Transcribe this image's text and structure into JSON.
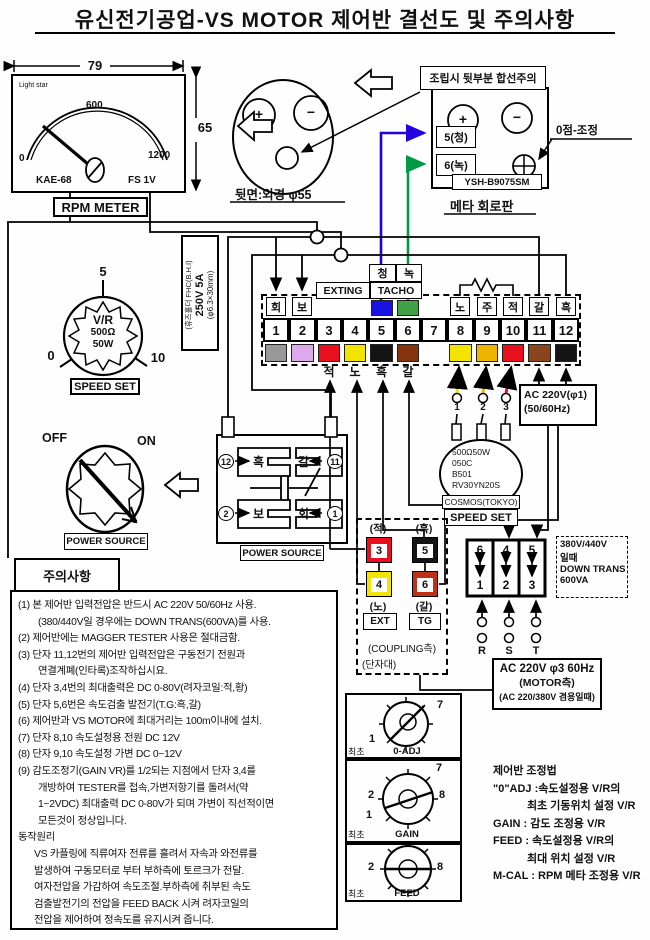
{
  "title": "유신전기공업-VS MOTOR 제어반 결선도 및 주의사항",
  "rpm": {
    "dim_w": "79",
    "dim_h": "65",
    "brand": "Light star",
    "s0": "0",
    "s600": "600",
    "s1200": "1200",
    "model": "KAE-68",
    "fs": "FS 1V",
    "label": "RPM METER"
  },
  "rear": {
    "plus": "+",
    "minus": "−",
    "label": "뒷면:외경 φ55"
  },
  "board": {
    "warning": "조립시 뒷부분 합선주의",
    "plus": "+",
    "minus": "−",
    "t5": "5(청)",
    "t6": "6(녹)",
    "model": "YSH-B9075SM",
    "zero": "0점-조정",
    "label": "메타 회로판"
  },
  "fuse": {
    "l1": "(휴즈홀더 FHC(B.H.I)",
    "l2": "250V 5A",
    "l3": "(φ6.3×30mm)"
  },
  "vr": {
    "s5": "5",
    "s0": "0",
    "s10": "10",
    "name": "V/R",
    "ohm": "500Ω",
    "watt": "50W",
    "label": "SPEED SET"
  },
  "sw": {
    "off": "OFF",
    "on": "ON",
    "label": "POWER SOURCE"
  },
  "relay": {
    "n12": "12",
    "blk": "흑",
    "brn": "갈",
    "n11": "11",
    "n2": "2",
    "bo": "보",
    "hoe": "회",
    "n1": "1",
    "label": "POWER SOURCE"
  },
  "strip": {
    "chung": "청",
    "nok": "녹",
    "exting": "EXTING",
    "tacho": "TACHO",
    "top1": "회",
    "top2": "보",
    "top8": "노",
    "top9": "주",
    "top10": "적",
    "top11": "갈",
    "top12": "흑",
    "numbers": [
      "1",
      "2",
      "3",
      "4",
      "5",
      "6",
      "7",
      "8",
      "9",
      "10",
      "11",
      "12"
    ],
    "bot3": "적",
    "bot4": "노",
    "bot5": "흑",
    "bot6": "갈",
    "w1": "1",
    "w2": "2",
    "w3": "3"
  },
  "ac1": {
    "l1": "AC 220V(φ1)",
    "l2": "(50/60Hz)"
  },
  "pot": {
    "l1": "500Ω50W",
    "l2": "050C",
    "l3": "B501",
    "l4": "RV30YN20S",
    "brand": "COSMOS(TOKYO)",
    "label": "SPEED SET"
  },
  "coupling": {
    "red": "(적)",
    "n3": "3",
    "n4": "4",
    "yel": "(노)",
    "ext": "EXT",
    "blk": "(흑)",
    "n5": "5",
    "n6": "6",
    "brn": "(갈)",
    "tg": "TG",
    "l1": "(COUPLING측)",
    "l2": "(단자대)"
  },
  "rst": {
    "c1t": "6",
    "c1b": "1",
    "c2t": "4",
    "c2b": "2",
    "c3t": "5",
    "c3b": "3",
    "r": "R",
    "s": "S",
    "t": "T"
  },
  "trans": {
    "l1": "380V/440V",
    "l2": "일때",
    "l3": "DOWN TRANS",
    "l4": "600VA"
  },
  "motor": {
    "l1": "AC 220V φ3 60Hz",
    "l2": "(MOTOR측)",
    "l3": "(AC 220/380V 겸용일때)"
  },
  "notes": {
    "title": "주의사항",
    "lines": [
      "(1) 본 제어반 입력전압은 반드시 AC 220V 50/60Hz 사용.",
      "(380/440V일 경우에는 DOWN TRANS(600VA)를 사용.",
      "(2) 제어반에는 MAGGER TESTER 사용은 절대금함.",
      "(3) 단자 11,12번의 제어반 입력전압은 구동전기 전원과",
      "연결계폐(인타록)조작하십시요.",
      "(4) 단자 3,4번의 최대출력은  DC 0-80V(려자코일:적,황)",
      "(5) 단자 5,6번은 속도검출 발전기(T.G:흑,갈)",
      "(6) 제어반과 VS MOTOR에 최대거리는 100m이내에 설치.",
      "(7) 단자 8,10 속도설정용 전원 DC 12V",
      "(8) 단자 9,10 속도설정 가변 DC 0~12V",
      "(9) 감도조정기(GAIN VR)를 1/2되는 지점에서 단자 3,4를",
      "개방하여 TESTER를 접속,가변저항기를 돌려서(약",
      "1~2VDC) 최대출력 DC 0-80V가 되며 가변이 직선적이면",
      "모든것이 정상입니다.",
      "동작원리",
      "VS 카플링에 직류여자 전류를 흘려서 자속과 와전류를",
      "발생하여 구동모터로 부터 부하측에 토르크가 전달.",
      "여자전압을 가감하여 속도조절.부하측에 취부된 속도",
      "검출발전기의 전압을 FEED BACK 시켜 려자코일의",
      "전압을 제어하여 정속도를 유지시켜 줍니다."
    ]
  },
  "knobs": {
    "k1": {
      "n7": "7",
      "n1": "1",
      "min": "최초",
      "name": "0-ADJ"
    },
    "k2": {
      "n7": "7",
      "n8": "8",
      "n2": "2",
      "n1": "1",
      "min": "최초",
      "name": "GAIN"
    },
    "k3": {
      "n2": "2",
      "n8": "8",
      "min": "최초",
      "name": "FEED"
    }
  },
  "adjust": {
    "lines": [
      "제어반 조정법",
      "\"0\"ADJ :속도설정용 V/R의",
      "최초 기동위치 설정 V/R",
      "GAIN : 감도 조정용 V/R",
      "FEED : 속도설정용 V/R의",
      "최대 위치 설정 V/R",
      "M-CAL : RPM 메타 조정용 V/R"
    ]
  },
  "colors": {
    "blue": "#2200dd",
    "green": "#009944",
    "red": "#e8101c",
    "yellow": "#f2e400",
    "orange": "#eeb400",
    "brown": "#84350f",
    "brown2": "#8c441c",
    "gray": "#989898",
    "violet": "#dcaaec",
    "black": "#141414"
  }
}
